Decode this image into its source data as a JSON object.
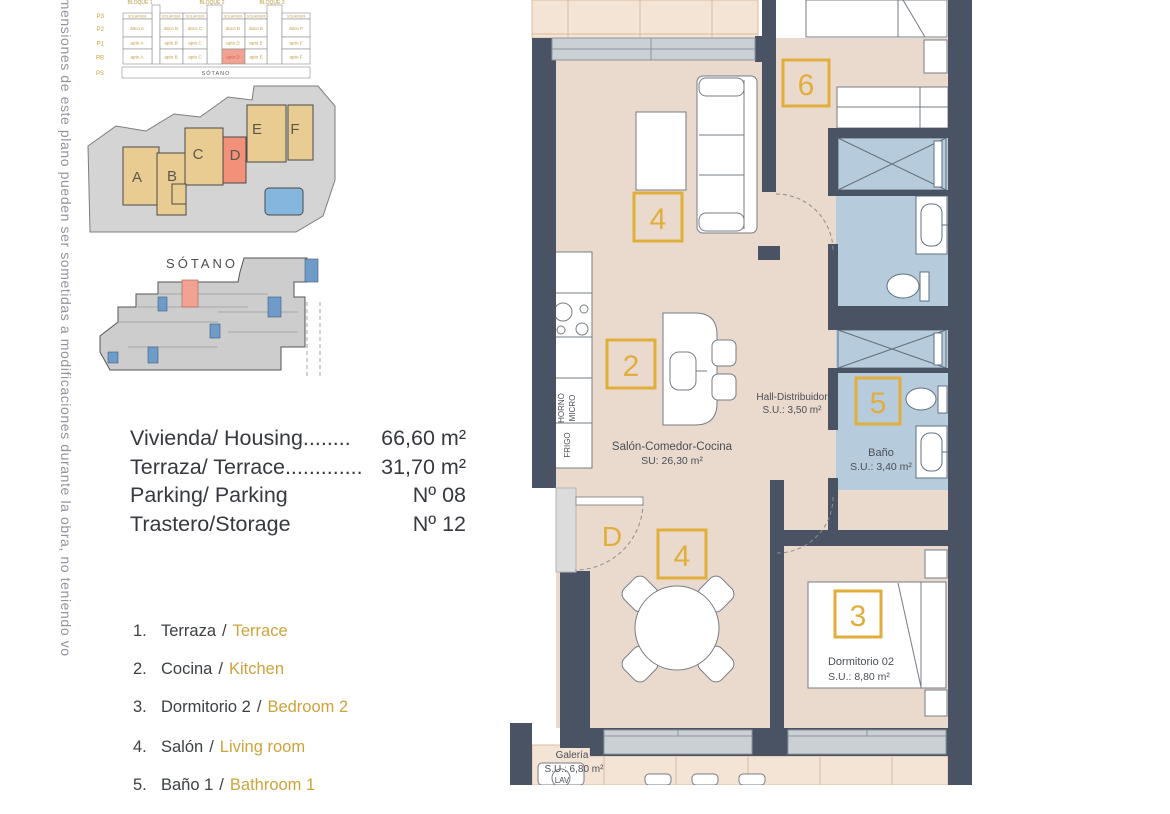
{
  "disclaimer": "imensiones de este plano pueden ser sometidas a modificaciones durante la obra, no teniendo vo",
  "elevation": {
    "block_labels": [
      "BLOQUE 1",
      "BLOQUE 2",
      "BLOQUE 3"
    ],
    "floor_labels": [
      "P3",
      "P2",
      "P1",
      "PB",
      "PS"
    ],
    "solarium": "SOLARIUM",
    "row_p2": [
      "ático A",
      "ático B",
      "ático C",
      "ático D",
      "ático E",
      "ático F"
    ],
    "row_p1": [
      "apto A",
      "apto B",
      "apto C",
      "apto D",
      "apto E",
      "apto F"
    ],
    "row_pb": [
      "apto A",
      "apto B",
      "apto C",
      "apto D",
      "apto E",
      "apto F"
    ],
    "basement": "SÓTANO"
  },
  "site_plan": {
    "building_labels": [
      "A",
      "B",
      "C",
      "D",
      "E",
      "F"
    ]
  },
  "sotano": {
    "title": "SÓTANO"
  },
  "info": {
    "rows": [
      {
        "label": "Vivienda/ Housing",
        "dots": "........",
        "value": "66,60 m²"
      },
      {
        "label": "Terraza/ Terrace",
        "dots": ".............",
        "value": "31,70 m²"
      },
      {
        "label": "Parking/ Parking",
        "dots": "",
        "value": "Nº 08"
      },
      {
        "label": "Trastero/Storage",
        "dots": "",
        "value": "Nº 12"
      }
    ]
  },
  "legend": {
    "separator": "/",
    "items": [
      {
        "num": "1.",
        "es": "Terraza",
        "en": "Terrace"
      },
      {
        "num": "2.",
        "es": "Cocina",
        "en": "Kitchen"
      },
      {
        "num": "3.",
        "es": "Dormitorio 2",
        "en": "Bedroom 2"
      },
      {
        "num": "4.",
        "es": "Salón",
        "en": "Living room"
      },
      {
        "num": "5.",
        "es": "Baño 1",
        "en": "Bathroom 1"
      }
    ]
  },
  "plan": {
    "badges": {
      "living": "4",
      "kitchen": "2",
      "bedroom1": "6",
      "bath2": "5",
      "dining": "4",
      "bedroom2": "3",
      "entrance": "D"
    },
    "labels": {
      "salon_line1": "Salón-Comedor-Cocina",
      "salon_line2": "SU: 26,30 m²",
      "hall_line1": "Hall-Distribuidor",
      "hall_line2": "S.U.: 3,50 m²",
      "bano_line1": "Baño",
      "bano_line2": "S.U.: 3,40 m²",
      "dorm2_line1": "Dormitorio 02",
      "dorm2_line2": "S.U.: 8,80 m²",
      "galeria_line1": "Galería",
      "galeria_line2": "S.U.: 6,80 m²",
      "horno": "HORNO",
      "micro": "MICRO",
      "frigo": "FRIGO",
      "lav": "LAV"
    },
    "colors": {
      "wall": "#4A5363",
      "floor": "#EADACD",
      "tile": "#F4E4D6",
      "bath": "#B6CBDB",
      "window": "#CBD0D5",
      "gold": "#E1AE3B",
      "highlight": "#F2A292"
    }
  }
}
